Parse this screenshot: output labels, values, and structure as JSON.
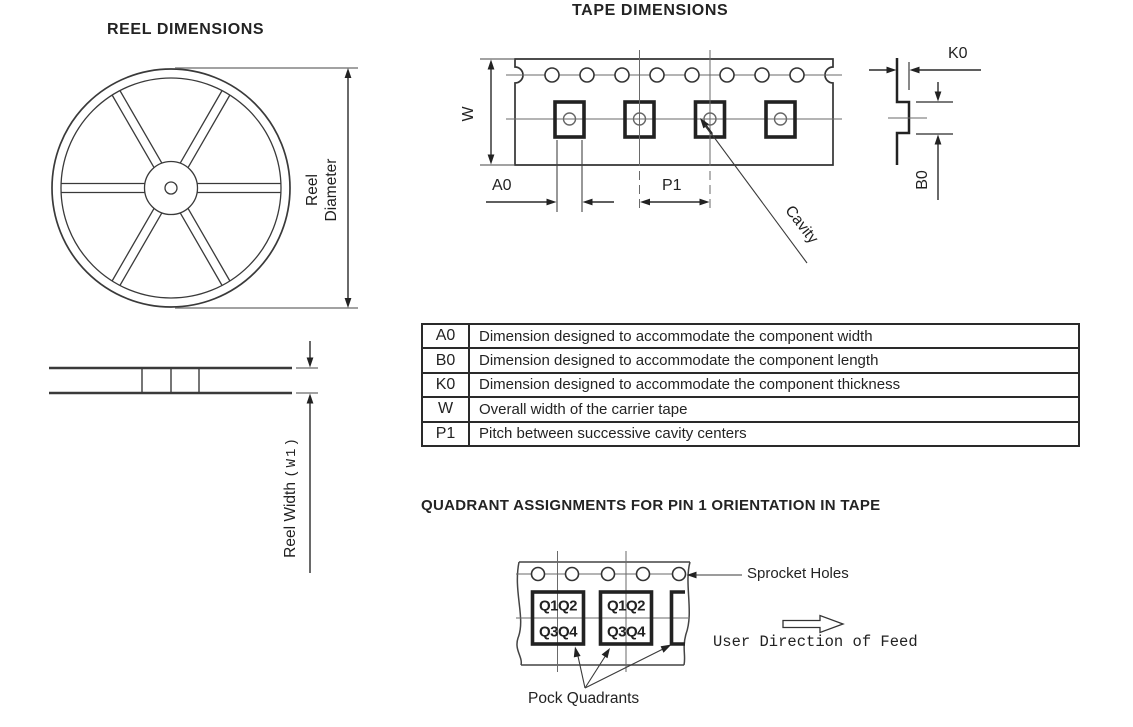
{
  "titles": {
    "reel": "REEL DIMENSIONS",
    "tape": "TAPE DIMENSIONS",
    "quadrant": "QUADRANT ASSIGNMENTS FOR PIN 1 ORIENTATION IN TAPE"
  },
  "reel_front": {
    "diameter_label_line1": "Reel",
    "diameter_label_line2": "Diameter"
  },
  "reel_side": {
    "width_label": "Reel Width",
    "width_label_suffix": "(W1)"
  },
  "tape": {
    "w_label": "W",
    "a0_label": "A0",
    "p1_label": "P1",
    "cavity_label": "Cavity"
  },
  "cross_section": {
    "k0_label": "K0",
    "b0_label": "B0"
  },
  "dimension_table": {
    "rows": [
      {
        "key": "A0",
        "description": "Dimension designed to accommodate the component width"
      },
      {
        "key": "B0",
        "description": "Dimension designed to accommodate the component length"
      },
      {
        "key": "K0",
        "description": "Dimension designed to accommodate the component thickness"
      },
      {
        "key": "W",
        "description": "Overall width of the carrier tape"
      },
      {
        "key": "P1",
        "description": "Pitch between successive cavity centers"
      }
    ]
  },
  "quadrant_figure": {
    "sprocket_label": "Sprocket Holes",
    "pocket_label": "Pock Quadrants",
    "feed_label": "User Direction of Feed",
    "quadrants_top": "Q1Q2",
    "quadrants_bottom": "Q3Q4"
  }
}
